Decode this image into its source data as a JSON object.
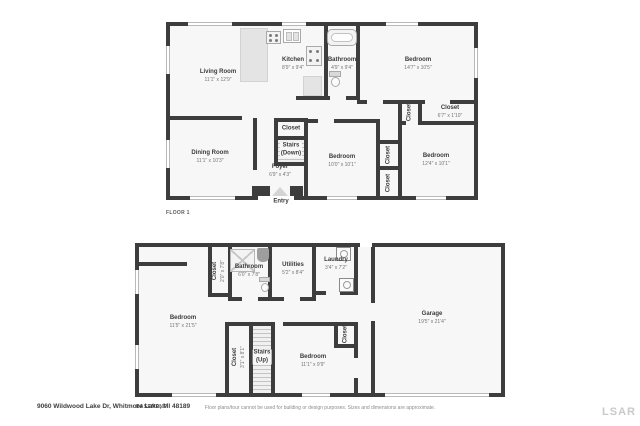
{
  "page": {
    "address": "9060 Wildwood Lake Dr, Whitmore Lake, MI 48189",
    "disclaimer": "Floor plans/tour cannot be used for building or design purposes. Sizes and dimensions are approximate.",
    "brand": "LSAR"
  },
  "colors": {
    "wall": "#3d3d3d",
    "room_fill": "#f7f7f7",
    "fixture_fill": "#e4e4e4",
    "text": "#3b3b3b",
    "dims_text": "#757575",
    "watermark": "#c9c9c9"
  },
  "floor1": {
    "label": "FLOOR 1",
    "entry_label": "Entry",
    "rooms": {
      "living": {
        "name": "Living Room",
        "dims": "11'1\" x 12'9\""
      },
      "kitchen": {
        "name": "Kitchen",
        "dims": "8'9\" x 9'4\""
      },
      "bathroom": {
        "name": "Bathroom",
        "dims": "4'9\" x 9'4\""
      },
      "bedroom_top": {
        "name": "Bedroom",
        "dims": "14'7\" x 10'5\""
      },
      "closet_hall": {
        "name": "Closet",
        "dims": "6'7\" x 1'10\""
      },
      "closet_hall_small": {
        "name": "Closet"
      },
      "dining": {
        "name": "Dining Room",
        "dims": "11'1\" x 10'3\""
      },
      "closet_stairs": {
        "name": "Closet"
      },
      "stairs": {
        "name": "Stairs",
        "sub": "(Down)"
      },
      "foyer": {
        "name": "Foyer",
        "dims": "6'9\" x 4'3\""
      },
      "bedroom_mid": {
        "name": "Bedroom",
        "dims": "10'0\" x 10'1\""
      },
      "closet_mid_upper": {
        "name": "Closet"
      },
      "closet_mid_lower": {
        "name": "Closet"
      },
      "bedroom_right": {
        "name": "Bedroom",
        "dims": "12'4\" x 10'1\""
      }
    }
  },
  "basement": {
    "label": "BASEMENT",
    "rooms": {
      "bedroom_left": {
        "name": "Bedroom",
        "dims": "11'5\" x 21'5\""
      },
      "closet_bath": {
        "name": "Closet",
        "dims": "2'0\" x 7'8\""
      },
      "bathroom": {
        "name": "Bathroom",
        "dims": "6'0\" x 7'8\""
      },
      "utilities": {
        "name": "Utilities",
        "dims": "5'2\" x 8'4\""
      },
      "laundry": {
        "name": "Laundry",
        "dims": "3'4\" x 7'2\""
      },
      "garage": {
        "name": "Garage",
        "dims": "19'5\" x 21'4\""
      },
      "closet_stairs": {
        "name": "Closet",
        "dims": "3'1\" x 8'1\""
      },
      "stairs": {
        "name": "Stairs",
        "sub": "(Up)"
      },
      "bedroom_small": {
        "name": "Bedroom",
        "dims": "11'1\" x 9'9\""
      },
      "closet_bedroom": {
        "name": "Closet"
      }
    }
  }
}
